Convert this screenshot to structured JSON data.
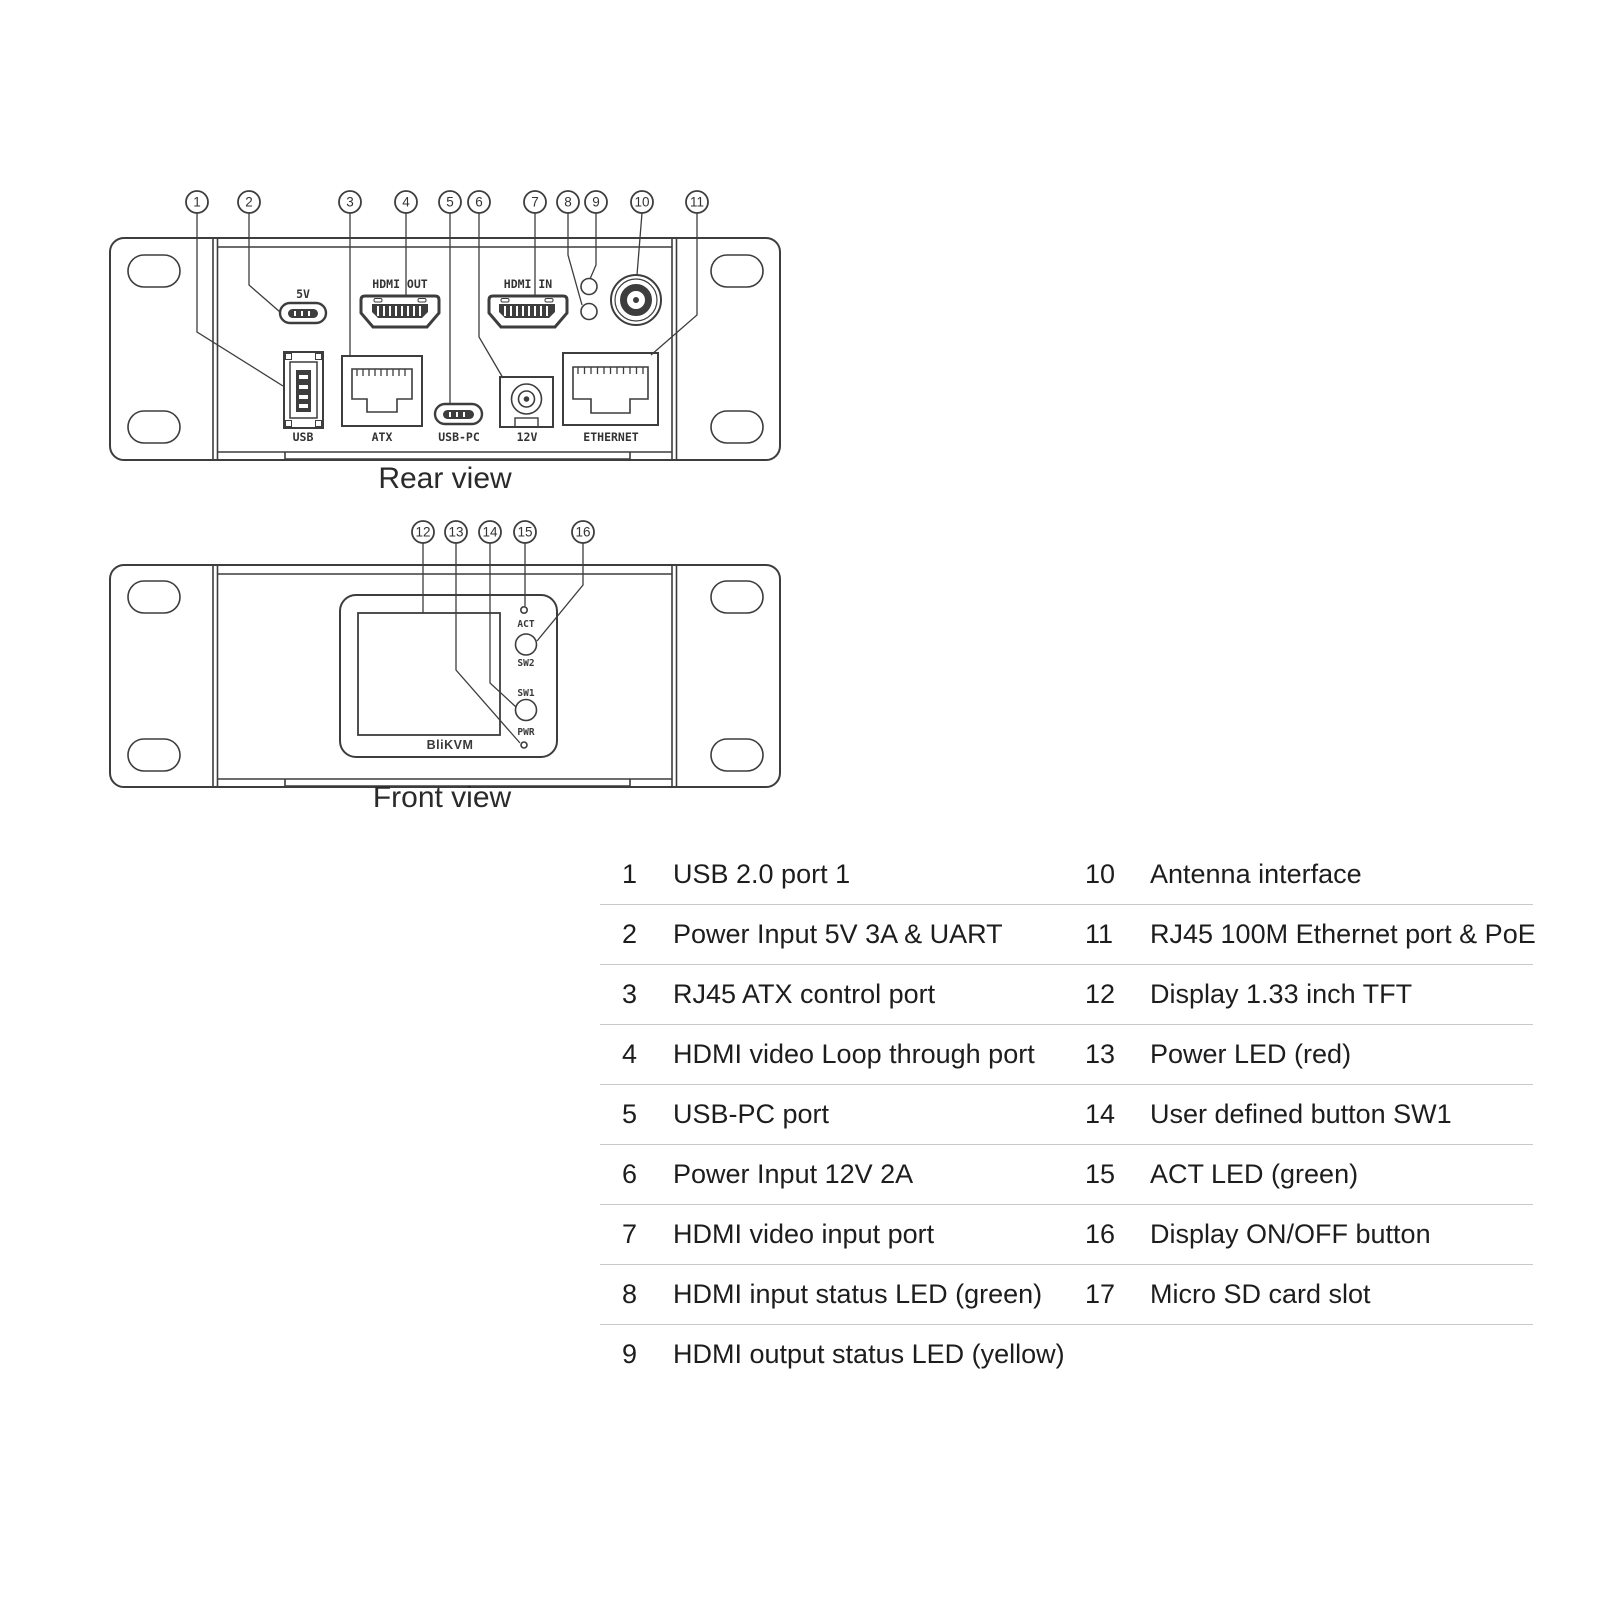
{
  "rear_view": {
    "caption": "Rear view",
    "callout_numbers": [
      "1",
      "2",
      "3",
      "4",
      "5",
      "6",
      "7",
      "8",
      "9",
      "10",
      "11"
    ],
    "port_labels": {
      "power_5v": "5V",
      "hdmi_out": "HDMI OUT",
      "hdmi_in": "HDMI IN",
      "usb": "USB",
      "atx": "ATX",
      "usb_pc": "USB-PC",
      "power_12v": "12V",
      "ethernet": "ETHERNET"
    }
  },
  "front_view": {
    "caption": "Front view",
    "callout_numbers": [
      "12",
      "13",
      "14",
      "15",
      "16"
    ],
    "panel_labels": {
      "act": "ACT",
      "sw2": "SW2",
      "sw1": "SW1",
      "pwr": "PWR",
      "brand": "BliKVM"
    }
  },
  "legend": {
    "left": [
      {
        "num": "1",
        "label": "USB 2.0 port 1"
      },
      {
        "num": "2",
        "label": "Power Input 5V 3A & UART"
      },
      {
        "num": "3",
        "label": "RJ45 ATX control port"
      },
      {
        "num": "4",
        "label": "HDMI video Loop through port"
      },
      {
        "num": "5",
        "label": "USB-PC port"
      },
      {
        "num": "6",
        "label": "Power Input 12V 2A"
      },
      {
        "num": "7",
        "label": "HDMI video input port"
      },
      {
        "num": "8",
        "label": "HDMI input status LED (green)"
      },
      {
        "num": "9",
        "label": "HDMI output status LED (yellow)"
      }
    ],
    "right": [
      {
        "num": "10",
        "label": "Antenna interface"
      },
      {
        "num": "11",
        "label": "RJ45 100M Ethernet port & PoE"
      },
      {
        "num": "12",
        "label": "Display 1.33 inch TFT"
      },
      {
        "num": "13",
        "label": "Power LED (red)"
      },
      {
        "num": "14",
        "label": "User defined button SW1"
      },
      {
        "num": "15",
        "label": "ACT LED (green)"
      },
      {
        "num": "16",
        "label": "Display ON/OFF button"
      },
      {
        "num": "17",
        "label": "Micro SD card slot"
      }
    ]
  },
  "colors": {
    "line_art": "#3d3d3d",
    "text": "#1d1d1f",
    "separator": "#c9c9c9",
    "background": "#ffffff"
  }
}
